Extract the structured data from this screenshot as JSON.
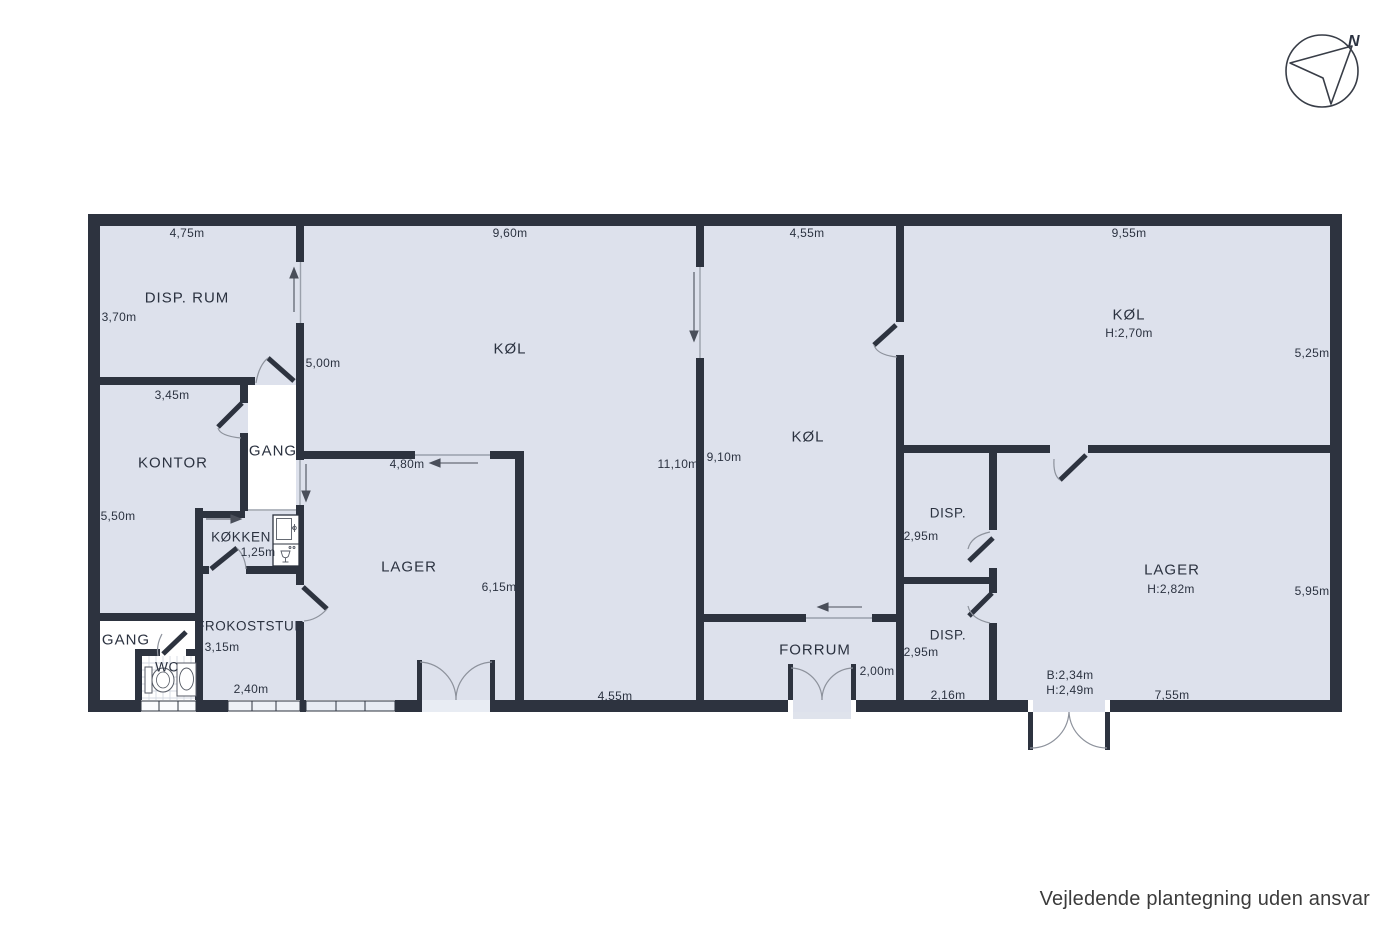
{
  "meta": {
    "disclaimer": "Vejledende plantegning uden ansvar"
  },
  "compass": {
    "north_label": "N"
  },
  "colors": {
    "floor": "#dde1ec",
    "wall": "#2d333f",
    "corridor": "#ffffff",
    "thin_line": "#9aa0ab",
    "arrow": "#4a4f5a"
  },
  "rooms": {
    "disp_rum": {
      "name": "DISP. RUM",
      "width": "4,75m",
      "depth": "3,70m"
    },
    "kontor": {
      "name": "KONTOR",
      "width": "3,45m",
      "depth": "5,50m"
    },
    "gang_top": {
      "name": "GANG",
      "length": "5,00m"
    },
    "koekken": {
      "name": "KØKKEN",
      "depth": "1,25m"
    },
    "frokoststue": {
      "name": "FROKOSTSTUE",
      "depth": "3,15m",
      "width": "2,40m"
    },
    "gang_bottom": {
      "name": "GANG"
    },
    "wc": {
      "name": "WC"
    },
    "koel_left": {
      "name": "KØL",
      "width": "9,60m",
      "depth": "11,10m"
    },
    "lager_left": {
      "name": "LAGER",
      "width": "4,80m",
      "depth": "6,15m",
      "bottom_width": "4,55m"
    },
    "koel_mid": {
      "name": "KØL",
      "width": "4,55m",
      "depth": "9,10m"
    },
    "forrum": {
      "name": "FORRUM",
      "door_width": "2,00m"
    },
    "koel_right": {
      "name": "KØL",
      "ceiling_height": "H:2,70m",
      "width": "9,55m",
      "depth": "5,25m"
    },
    "disp_upper": {
      "name": "DISP.",
      "width": "2,95m"
    },
    "disp_lower": {
      "name": "DISP.",
      "width": "2,95m",
      "bottom_width": "2,16m"
    },
    "lager_right": {
      "name": "LAGER",
      "ceiling_height": "H:2,82m",
      "depth": "5,95m",
      "bottom_width": "7,55m",
      "door_width": "B:2,34m",
      "door_height": "H:2,49m"
    }
  }
}
